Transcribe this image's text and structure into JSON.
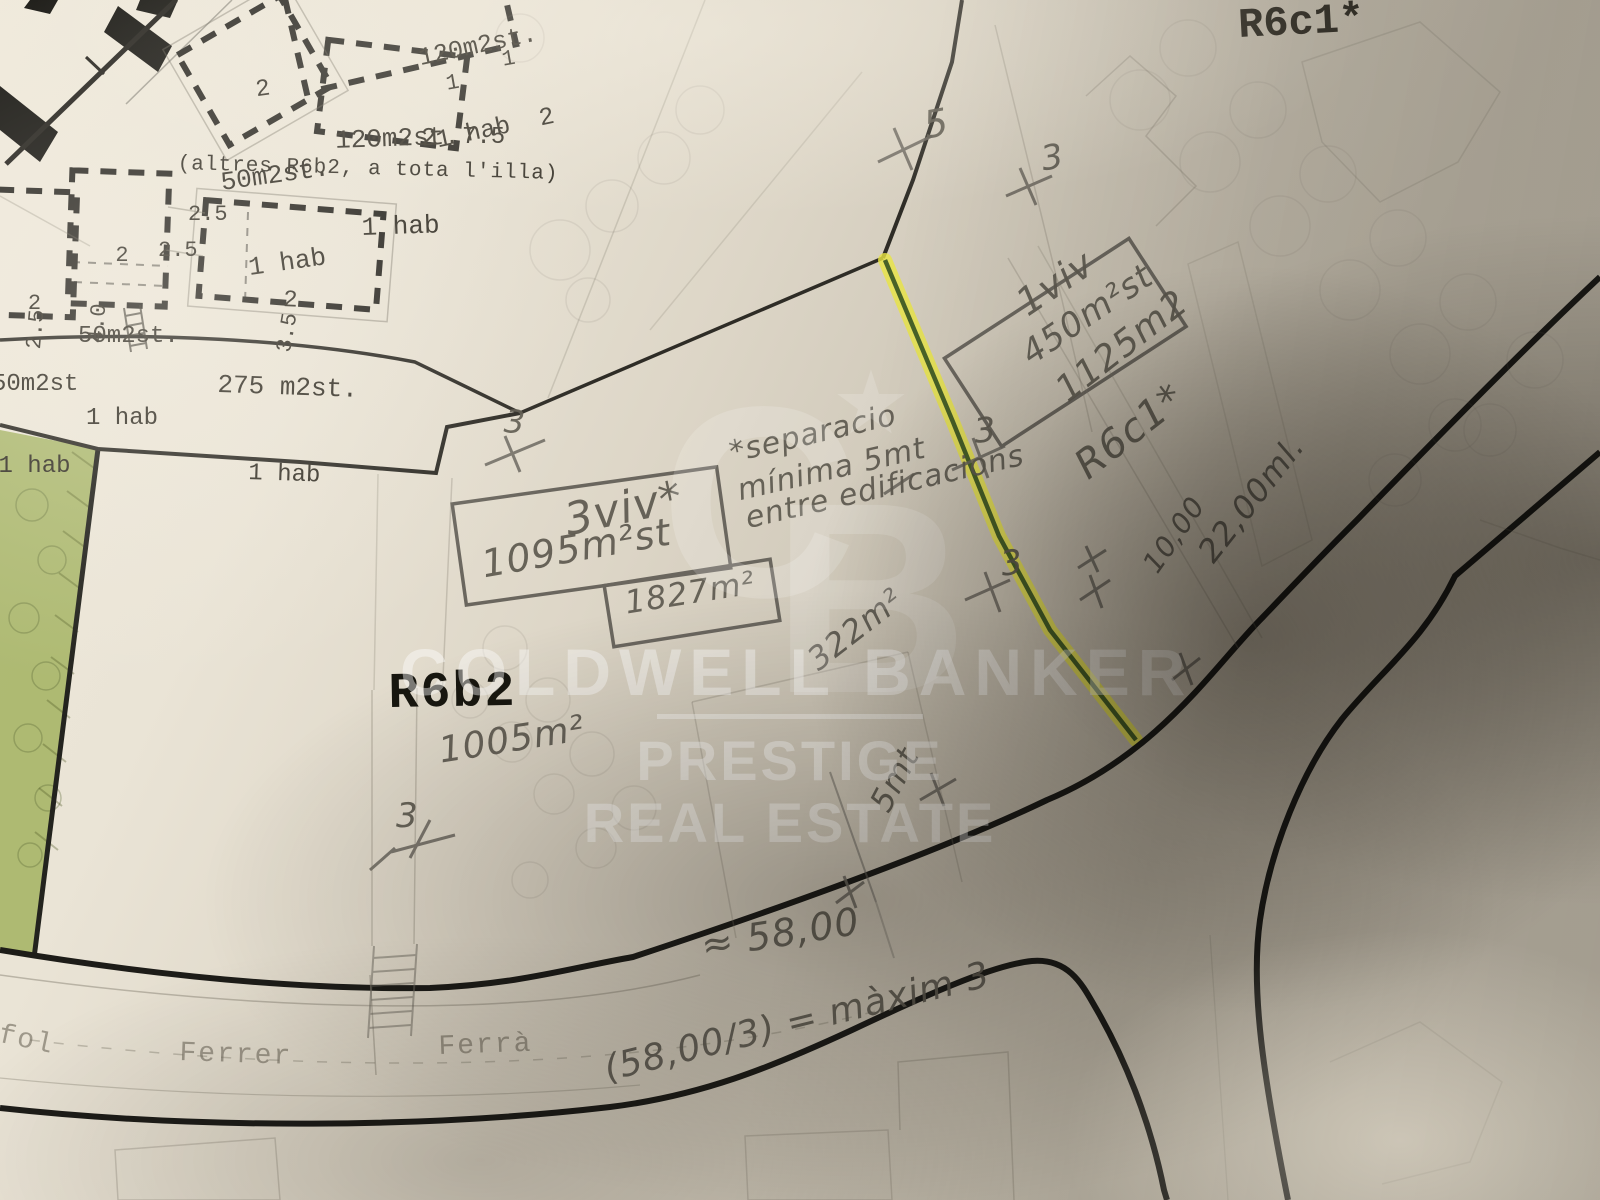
{
  "zones": {
    "r6c1_printed": "R6c1*",
    "r6b2_printed": "R6b2",
    "altres_note": "(altres R6b2, a tota l'illa)"
  },
  "parcels": {
    "p_top_cut": {
      "l1": "120m2st.",
      "l2": "1 hab  2"
    },
    "p_50_upper": {
      "l1": "2",
      "l2": "50m2st.",
      "l3": "1 hab"
    },
    "p_120": {
      "l1": "120m2st.",
      "l2": "1 hab"
    },
    "p_50_left": {
      "l1": "2",
      "l2": "50m2st.",
      "l3": "1 hab"
    },
    "p_50_edge": {
      "l1": "2",
      "l2": "50m2st",
      "l3": "1 hab"
    },
    "p_275": {
      "l1": "2",
      "l2": "275 m2st.",
      "l3": "1 hab"
    }
  },
  "printed_dims": {
    "d75": "7.5",
    "d25a": "2.5",
    "d25b": "2.5",
    "d25c": "2.5",
    "d40": "4.0",
    "d35": "3.5",
    "n1a": "1",
    "n1b": "1",
    "n2a": "2"
  },
  "streets": {
    "s1": "fol",
    "s2": "Ferrer",
    "s3": "Ferrà"
  },
  "handwritten": {
    "viv3": "3viv*",
    "a1095": "1095m²st",
    "a1827": "1827m²",
    "a322": "322m²",
    "a1005": "1005m²",
    "viv1": "1viv",
    "a450": "450m²st",
    "a1125": "1125m2",
    "r6c1_hand": "R6c1*",
    "sep1": "*separacio",
    "sep2": "mínima 5mt",
    "sep3": "entre edificacions",
    "d1000": "10,00",
    "d2200": "22,00ml.",
    "d5mt": "5mt",
    "d5800": "≈ 58,00",
    "formula": "(58,00/3) = màxim 3",
    "mark5": "5",
    "mark3": "3"
  },
  "watermark": {
    "monogram_c": "C",
    "monogram_b": "B",
    "star": "★",
    "brand": "COLDWELL BANKER",
    "sub1": "PRESTIGE",
    "sub2": "REAL ESTATE"
  },
  "colors": {
    "paper": "#e9e3d5",
    "print_black": "#33302a",
    "graphite": "#5f5b52",
    "highlighter": "#e8e542",
    "highlighter_core": "#2c4a1e",
    "green_zone": "#a5b464"
  }
}
